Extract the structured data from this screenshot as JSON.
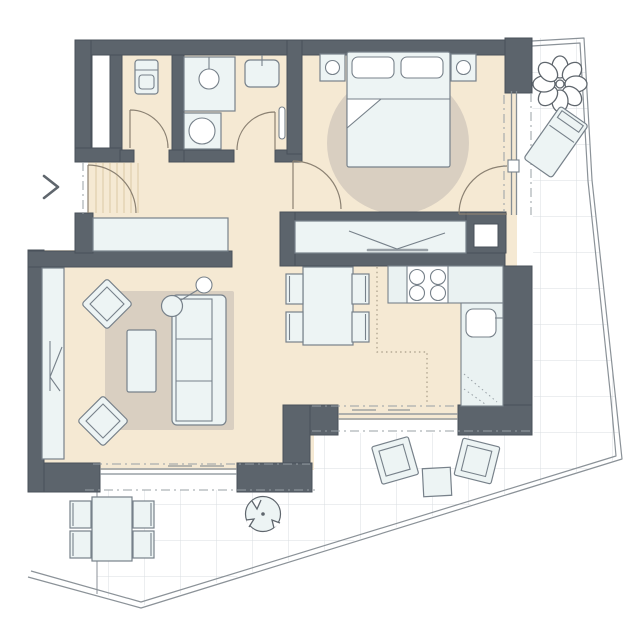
{
  "meta": {
    "kind": "architectural-floor-plan",
    "visible_text_labels": []
  },
  "palette": {
    "wall": "#5c646c",
    "wall_outline": "#49515a",
    "floor": "#f5e9d3",
    "rug": "#d9cfc1",
    "furniture_fill": "#edf4f4",
    "furniture_stroke": "#77818a",
    "counter_fill": "#eaf2f2",
    "grid_line": "#d9dde1",
    "boundary_line": "#8b9298",
    "dashdot_line": "#98a0a6",
    "door_arc": "#8b8172",
    "hatch_line": "#dbc9a5",
    "cabinet_dotted": "#a89d88",
    "glass_line": "#848d94",
    "plant_stroke": "#5f666d",
    "background": "#ffffff"
  },
  "floorplan": {
    "rooms": [
      {
        "name": "entry-hall",
        "items": [
          "entrance-door-swing",
          "entrance-doormat",
          "sideboard",
          "entrance-direction-chevron"
        ]
      },
      {
        "name": "storage-room",
        "items": [
          "small-appliance",
          "door-swing"
        ]
      },
      {
        "name": "bathroom",
        "items": [
          "shower",
          "washing-machine",
          "washbasin",
          "towel-radiator",
          "door-swing"
        ]
      },
      {
        "name": "bedroom",
        "items": [
          "double-bed",
          "pillow-left",
          "pillow-right",
          "nightstand-left",
          "nightstand-right",
          "bed-lamps",
          "round-rug",
          "door-swing",
          "terrace-door-swing",
          "glass-facade"
        ]
      },
      {
        "name": "hall-closet",
        "items": [
          "wardrobe-with-rail",
          "service-shaft-column"
        ]
      },
      {
        "name": "living-room",
        "items": [
          "sofa-3-seat",
          "coffee-table",
          "armchair-top",
          "armchair-bottom",
          "floor-lamp",
          "area-rug",
          "tall-cabinet",
          "sliding-glass-door"
        ]
      },
      {
        "name": "kitchen-dining",
        "items": [
          "dining-table",
          "dining-chairs-x4",
          "counter-with-cooktop",
          "counter-with-sink",
          "upper-cabinet-dotted-outline",
          "sliding-glass-door"
        ]
      },
      {
        "name": "terrace",
        "items": [
          "tile-grid",
          "parapet-boundary",
          "flower-plant",
          "sun-lounger",
          "outdoor-dining-table",
          "outdoor-chairs-x4",
          "round-shrub",
          "lounge-chair-left",
          "lounge-chair-right",
          "outdoor-side-table"
        ]
      }
    ]
  }
}
